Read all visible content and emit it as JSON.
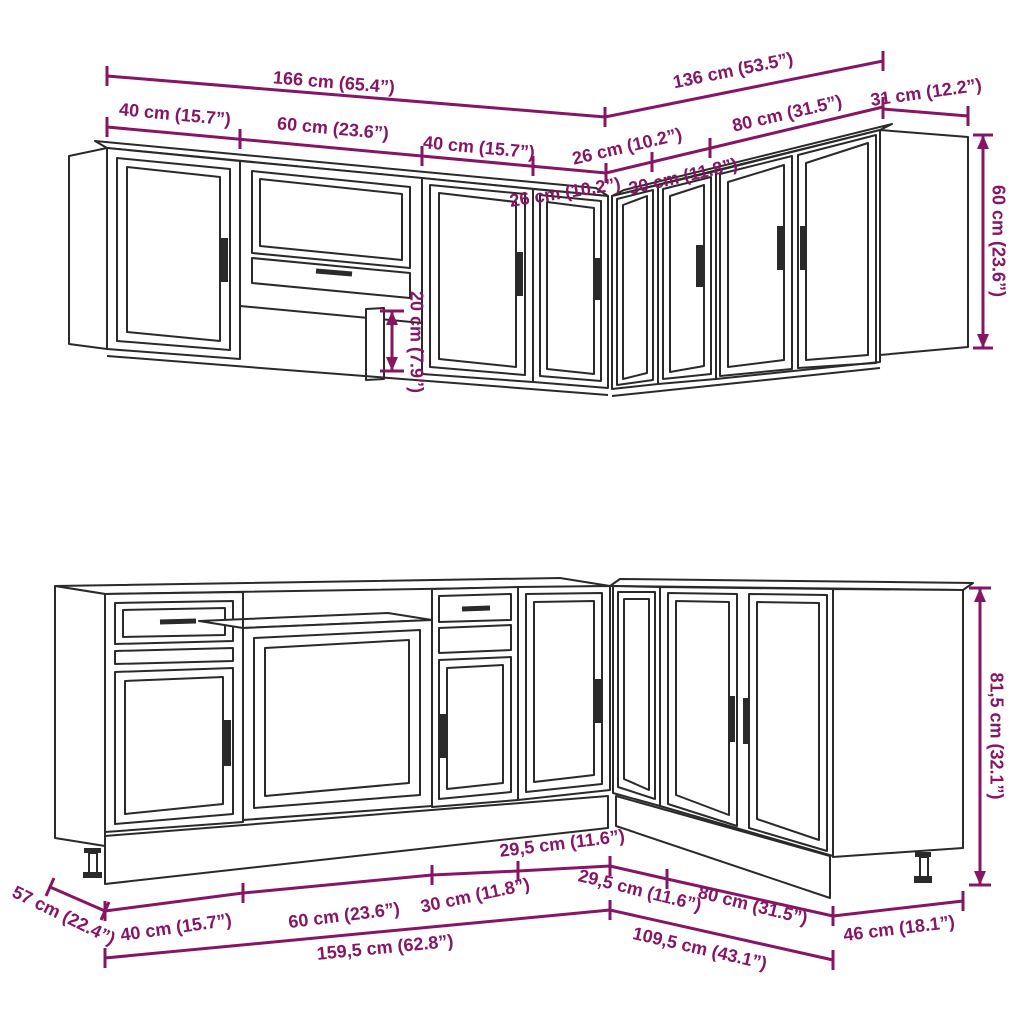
{
  "diagram": {
    "kind": "kitchen-cabinet-set-dimension-drawing",
    "colors": {
      "accent": "#871566",
      "line": "#2a2a2a",
      "background": "#ffffff"
    },
    "upper_run": {
      "total_left": "166 cm (65.4”)",
      "total_right": "136 cm (53.5”)",
      "end_depth": "31 cm (12.2”)",
      "left_segments": [
        "40 cm (15.7”)",
        "60 cm (23.6”)",
        "40 cm (15.7”)",
        "26 cm (10.2”)"
      ],
      "right_segments": [
        "26 cm (10.2”)",
        "30 cm (11.8”)",
        "80 cm (31.5”)"
      ],
      "height": "60 cm (23.6”)",
      "underpass_height": "20 cm (7.9”)"
    },
    "base_run": {
      "left_segments": [
        "40 cm (15.7”)",
        "60 cm (23.6”)",
        "30 cm (11.8”)",
        "29,5 cm (11.6”)"
      ],
      "right_segments": [
        "29,5 cm (11.6”)",
        "80 cm (31.5”)"
      ],
      "total_left": "159,5 cm (62.8”)",
      "total_right": "109,5 cm (43.1”)",
      "left_depth": "57 cm (22.4”)",
      "end_depth": "46 cm (18.1”)",
      "height": "81,5 cm (32.1”)"
    }
  }
}
